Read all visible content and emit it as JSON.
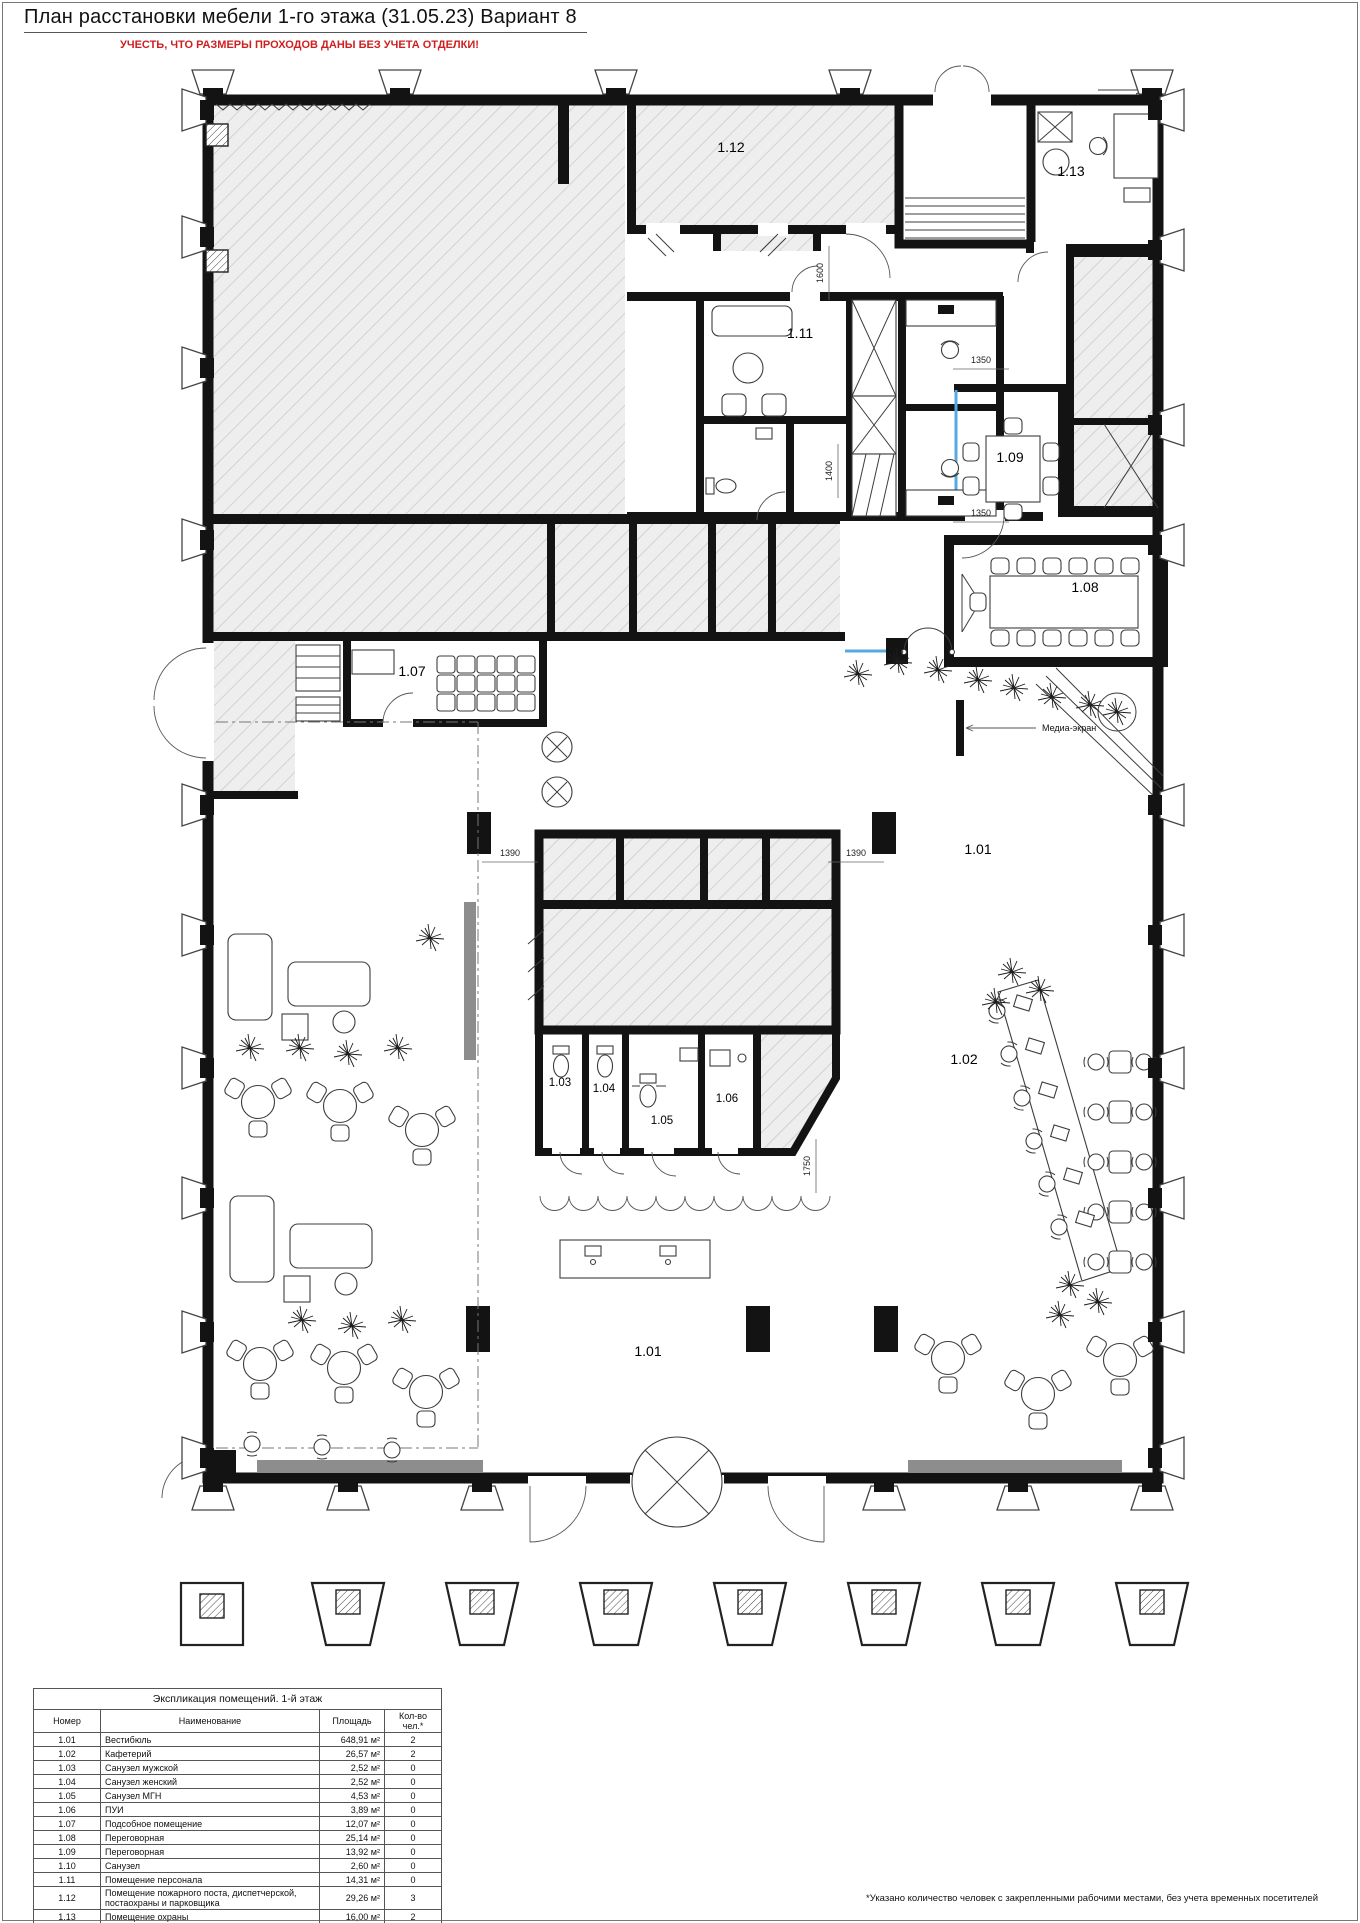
{
  "page": {
    "title": "План расстановки мебели 1-го этажа (31.05.23) Вариант 8",
    "warning": "УЧЕСТЬ, ЧТО РАЗМЕРЫ ПРОХОДОВ ДАНЫ БЕЗ УЧЕТА ОТДЕЛКИ!"
  },
  "colors": {
    "accent_blue": "#55aadf",
    "warning_red": "#cf1f1f",
    "wall": "#131313",
    "hatch_fill": "#efeeee"
  },
  "plan": {
    "room_labels": [
      {
        "id": "1.12",
        "x": 731,
        "y": 152
      },
      {
        "id": "1.13",
        "x": 1071,
        "y": 176
      },
      {
        "id": "1.11",
        "x": 800,
        "y": 338
      },
      {
        "id": "1.09",
        "x": 1010,
        "y": 462
      },
      {
        "id": "1.08",
        "x": 1085,
        "y": 592
      },
      {
        "id": "1.07",
        "x": 412,
        "y": 676
      },
      {
        "id": "1.01",
        "x": 978,
        "y": 854
      },
      {
        "id": "1.02",
        "x": 964,
        "y": 1064
      },
      {
        "id": "1.03",
        "x": 560,
        "y": 1086,
        "small": true
      },
      {
        "id": "1.04",
        "x": 604,
        "y": 1092,
        "small": true
      },
      {
        "id": "1.05",
        "x": 662,
        "y": 1124,
        "small": true
      },
      {
        "id": "1.06",
        "x": 727,
        "y": 1102,
        "small": true
      },
      {
        "id": "1.01",
        "x": 648,
        "y": 1356
      }
    ],
    "dimensions": [
      {
        "text": "1600",
        "x": 823,
        "y": 273,
        "vertical": true
      },
      {
        "text": "1350",
        "x": 981,
        "y": 363,
        "vertical": false
      },
      {
        "text": "1400",
        "x": 832,
        "y": 471,
        "vertical": true
      },
      {
        "text": "1350",
        "x": 981,
        "y": 516,
        "vertical": false
      },
      {
        "text": "1390",
        "x": 510,
        "y": 856,
        "vertical": false
      },
      {
        "text": "1390",
        "x": 856,
        "y": 856,
        "vertical": false
      },
      {
        "text": "1750",
        "x": 810,
        "y": 1166,
        "vertical": true
      }
    ],
    "annotations": [
      {
        "text": "Медиа-экран",
        "x": 1042,
        "y": 731
      }
    ]
  },
  "legend_table": {
    "title": "Экспликация помещений. 1-й этаж",
    "columns": [
      "Номер",
      "Наименование",
      "Площадь",
      "Кол-во чел.*"
    ],
    "rows": [
      [
        "1.01",
        "Вестибюль",
        "648,91 м²",
        "2"
      ],
      [
        "1.02",
        "Кафетерий",
        "26,57 м²",
        "2"
      ],
      [
        "1.03",
        "Санузел мужской",
        "2,52 м²",
        "0"
      ],
      [
        "1.04",
        "Санузел женский",
        "2,52 м²",
        "0"
      ],
      [
        "1.05",
        "Санузел МГН",
        "4,53 м²",
        "0"
      ],
      [
        "1.06",
        "ПУИ",
        "3,89 м²",
        "0"
      ],
      [
        "1.07",
        "Подсобное помещение",
        "12,07 м²",
        "0"
      ],
      [
        "1.08",
        "Переговорная",
        "25,14 м²",
        "0"
      ],
      [
        "1.09",
        "Переговорная",
        "13,92 м²",
        "0"
      ],
      [
        "1.10",
        "Санузел",
        "2,60 м²",
        "0"
      ],
      [
        "1.11",
        "Помещение персонала",
        "14,31 м²",
        "0"
      ],
      [
        "1.12",
        "Помещение пожарного поста, диспетчерской, постаохраны и парковщика",
        "29,26 м²",
        "3"
      ],
      [
        "1.13",
        "Помещение охраны",
        "16,00 м²",
        "2"
      ]
    ],
    "total_area": "802,26 м²",
    "total_people": "9"
  },
  "footnote": "*Указано количество человек с закрепленными рабочими местами, без учета временных посетителей"
}
